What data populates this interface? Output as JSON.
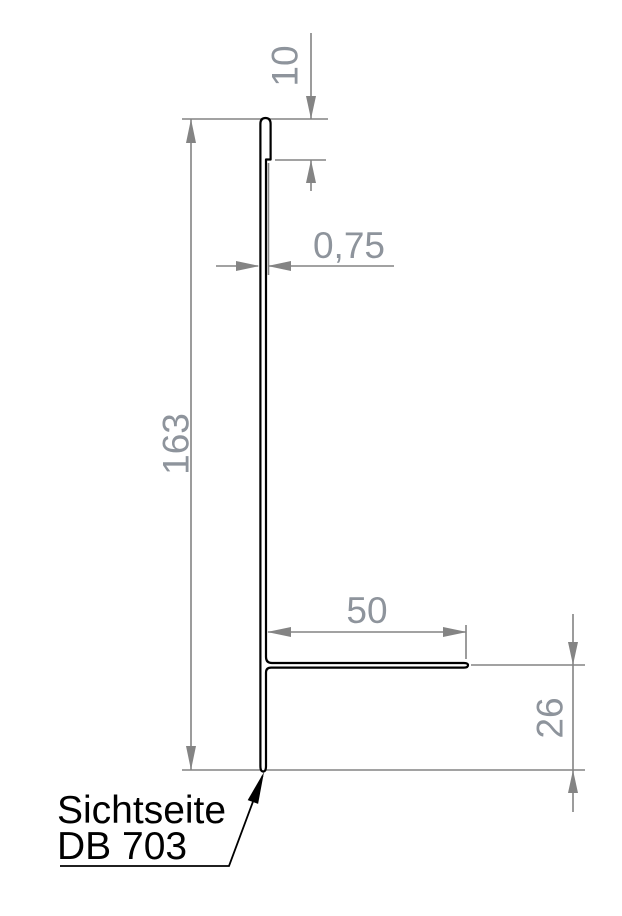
{
  "drawing": {
    "type": "sheet-metal-profile-cross-section",
    "dimensions": {
      "hem_height": "10",
      "thickness": "0,75",
      "profile_height": "163",
      "flange_width": "50",
      "bottom_offset": "26"
    },
    "annotation": {
      "line1": "Sichtseite",
      "line2": "DB 703"
    }
  },
  "colors": {
    "background": "#ffffff",
    "profile_line": "#000000",
    "dimension_line": "#848484",
    "dimension_text": "#8e949c",
    "annotation_text": "#000000"
  }
}
